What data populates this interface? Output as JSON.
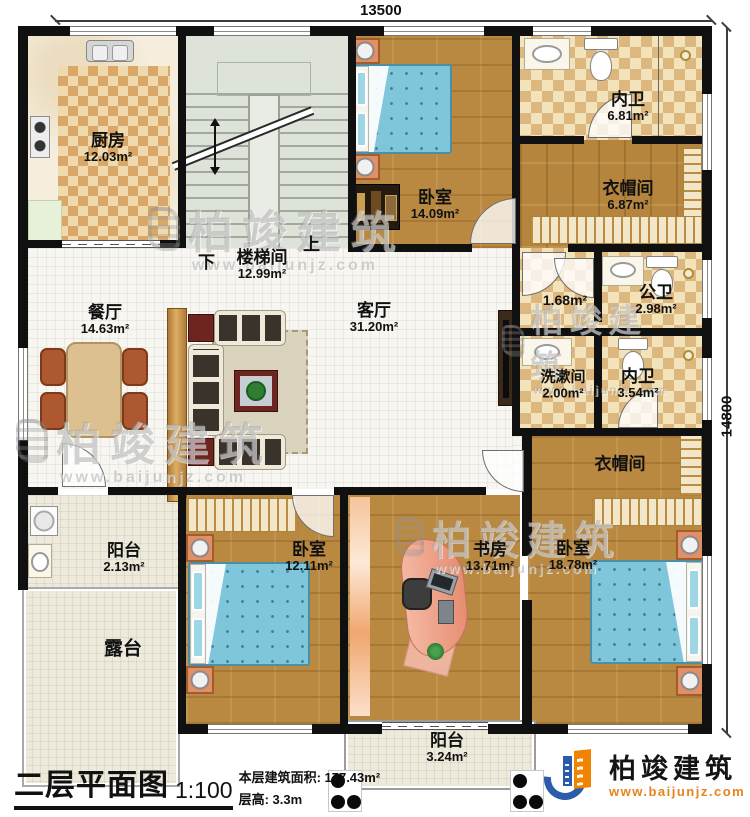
{
  "title_block": {
    "plan_title": "二层平面图",
    "scale": "1:100",
    "building_area": "本层建筑面积: 177.43m²",
    "floor_height": "层高: 3.3m"
  },
  "dimensions": {
    "top_width": "13500",
    "right_height": "14800"
  },
  "stairwell": {
    "down_label": "下",
    "up_label": "上"
  },
  "rooms": [
    {
      "name": "厨房",
      "area": "12.03m²"
    },
    {
      "name": "楼梯间",
      "area": "12.99m²"
    },
    {
      "name": "卧室",
      "area": "14.09m²"
    },
    {
      "name": "内卫",
      "area": "6.81m²"
    },
    {
      "name": "衣帽间",
      "area": "6.87m²"
    },
    {
      "name": "",
      "area": "1.68m²"
    },
    {
      "name": "公卫",
      "area": "2.98m²"
    },
    {
      "name": "洗漱间",
      "area": "2.00m²"
    },
    {
      "name": "内卫",
      "area": "3.54m²"
    },
    {
      "name": "餐厅",
      "area": "14.63m²"
    },
    {
      "name": "客厅",
      "area": "31.20m²"
    },
    {
      "name": "衣帽间",
      "area": ""
    },
    {
      "name": "阳台",
      "area": "2.13m²"
    },
    {
      "name": "露台",
      "area": ""
    },
    {
      "name": "卧室",
      "area": "12.11m²"
    },
    {
      "name": "书房",
      "area": "13.71m²"
    },
    {
      "name": "卧室",
      "area": "18.78m²"
    },
    {
      "name": "阳台",
      "area": "3.24m²"
    }
  ],
  "watermark": {
    "brand": "柏竣建筑",
    "site": "www.baijunjz.com"
  },
  "logo": {
    "brand": "柏竣建筑",
    "site": "www.baijunjz.com"
  },
  "colors": {
    "wall": "#101010",
    "wood": "#b5853e",
    "bed_blue": "#7fc6da",
    "logo_blue": "#2b5cab",
    "logo_orange": "#f08300"
  }
}
